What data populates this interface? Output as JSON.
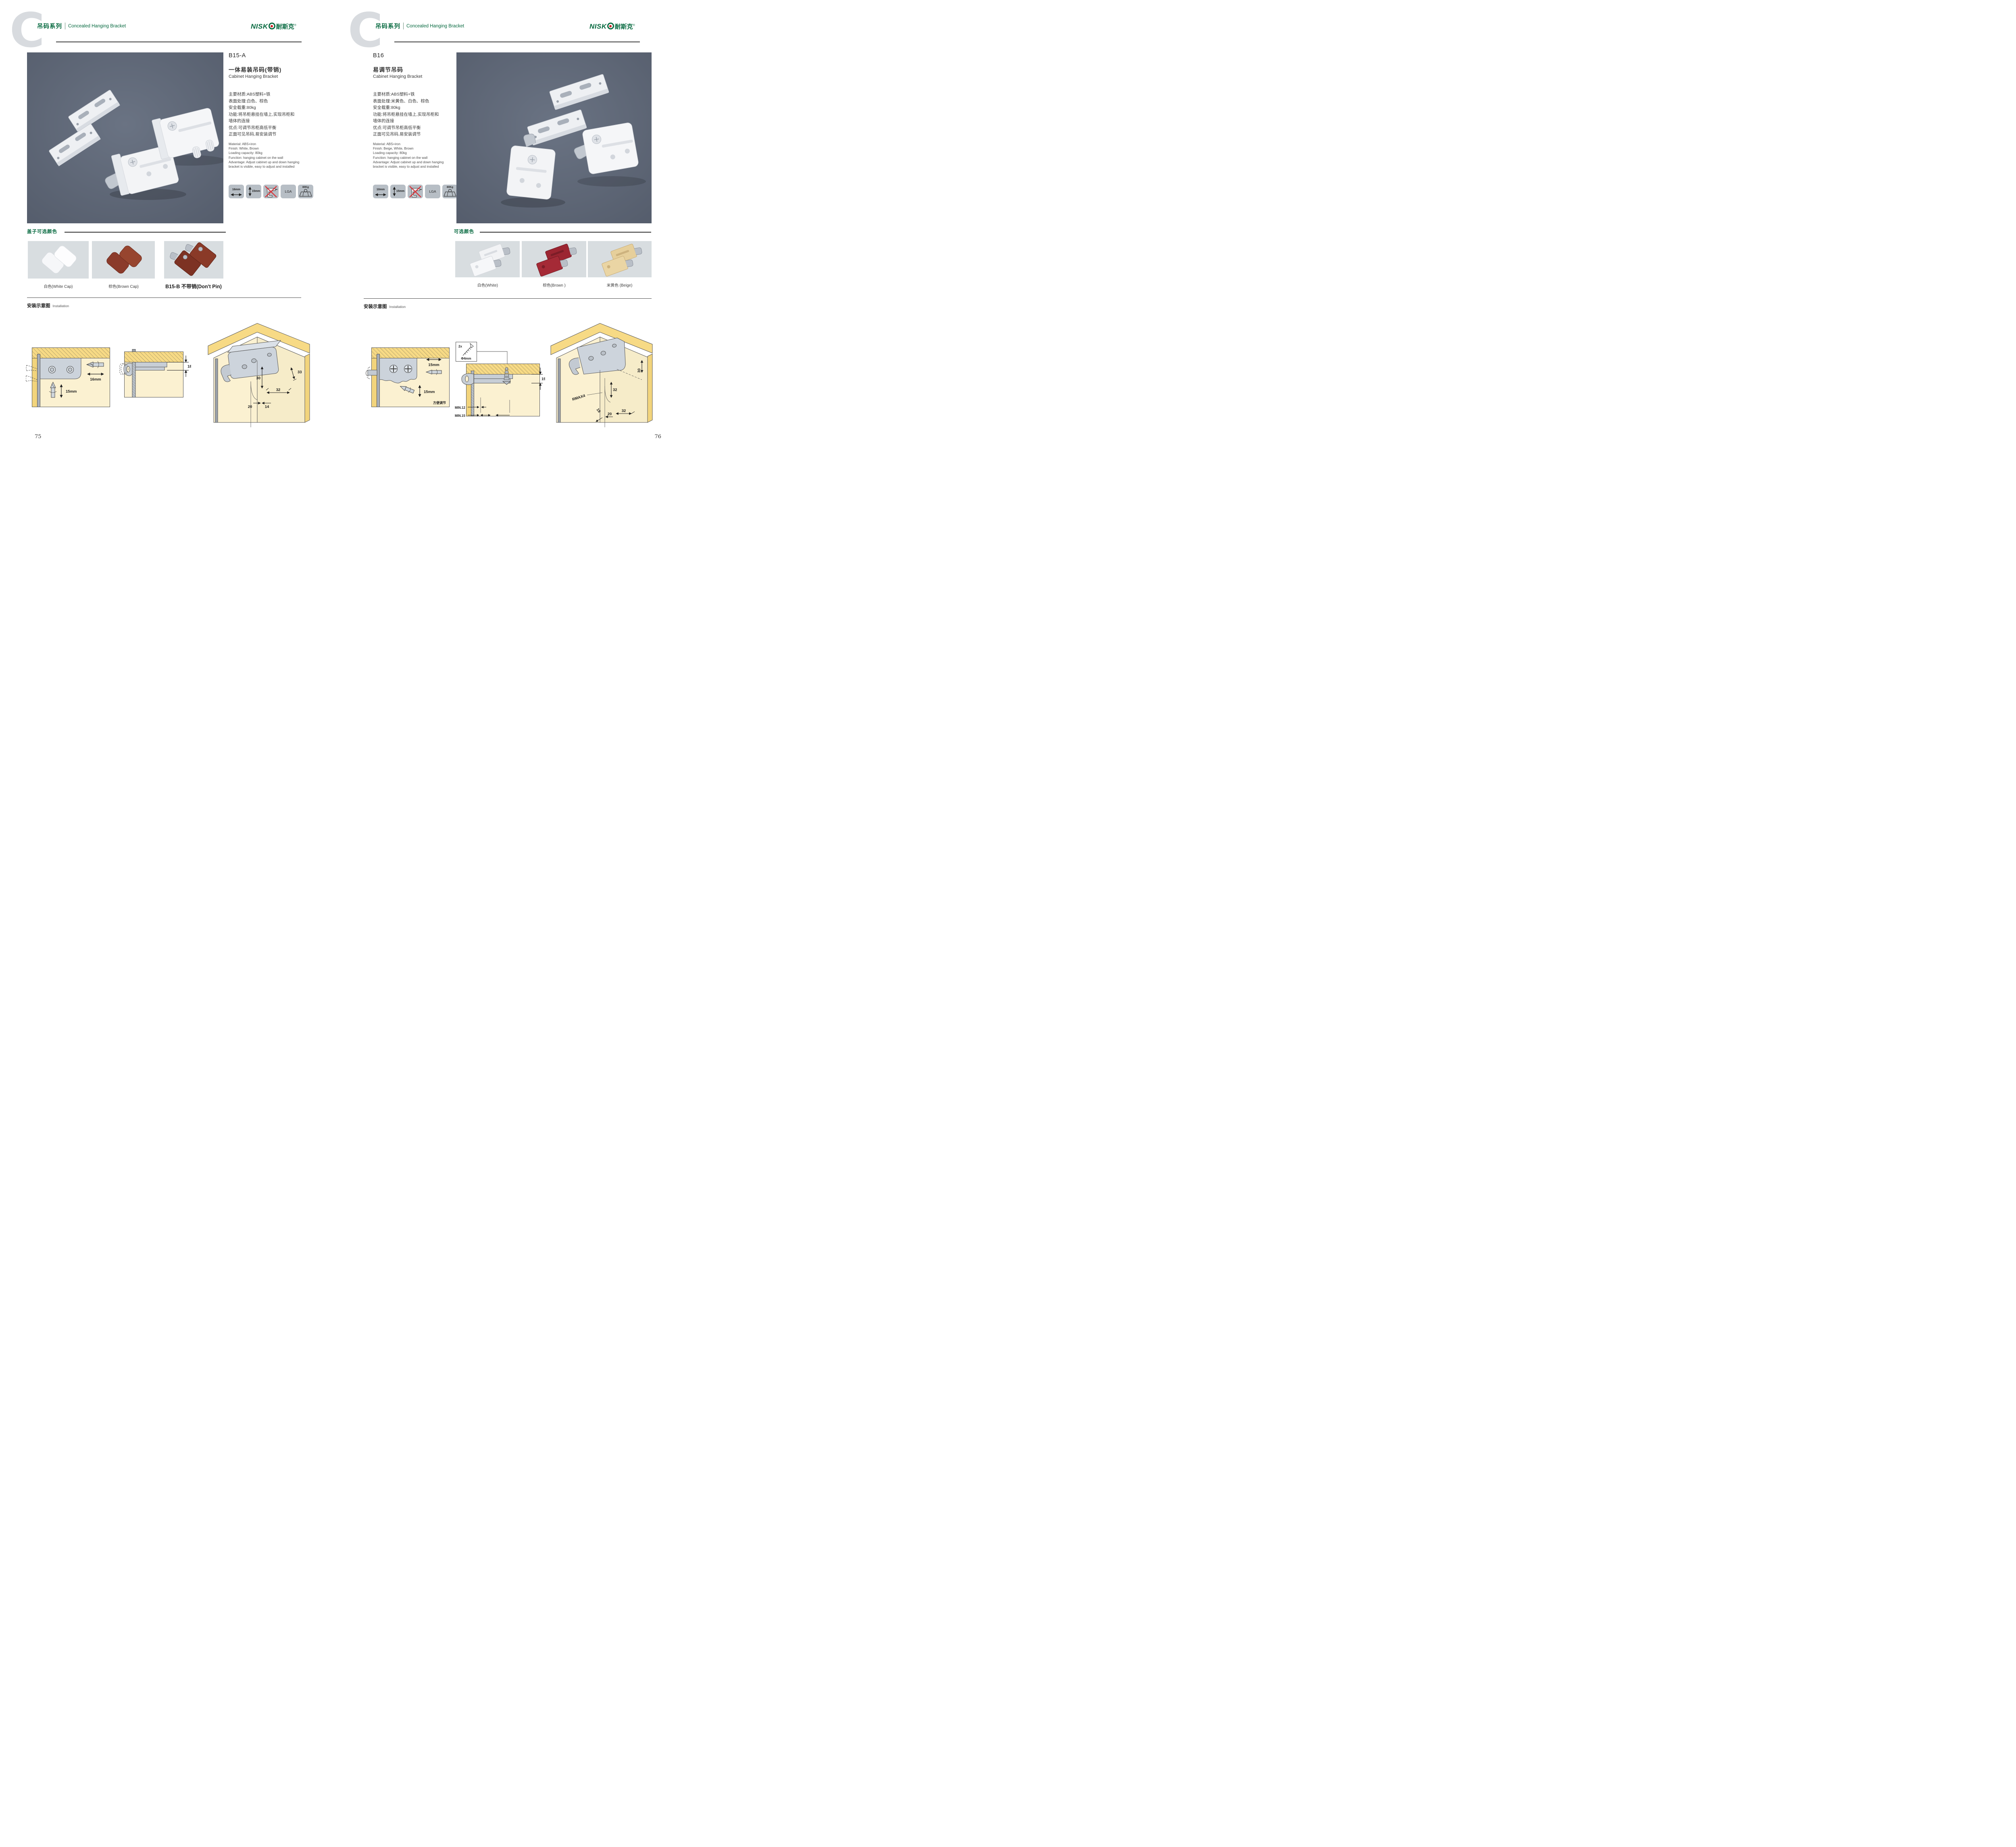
{
  "brand": {
    "latin": "NISK",
    "cn": "耐斯克",
    "reg": "®"
  },
  "colors": {
    "accent_green": "#06693f",
    "photo_bg": "#5c6473",
    "swatch_bg": "#d8dde0",
    "tile_bg": "#b7bec5",
    "wood_yellow": "#f7da85",
    "panel_cream": "#fbf1d1",
    "warn_red": "#d8363c"
  },
  "left": {
    "watermark": "C",
    "series_cn": "吊码系列",
    "series_en": "Concealed Hanging Bracket",
    "model": "B15-A",
    "name_cn": "一体易装吊码(带销)",
    "name_en": "Cabinet Hanging Bracket",
    "specs_cn": [
      "主要材质:ABS塑料+铁",
      "表面处理:白色、棕色",
      "安全载重:80kg",
      "功能:将吊柜悬挂在墙上,实现吊柜和",
      "墙体的连接",
      "优点:可调节吊柜高低平衡",
      "正面可见吊码,易安装调节"
    ],
    "specs_en": [
      "Material: ABS+iron",
      "Finish: White, Brown",
      "Loading capacity: 80kg",
      "Function: hanging cabinet on the wall",
      "Advantage: Adjust cabinet up and down hanging",
      "bracket is visible, easy to adjust and installed"
    ],
    "icons": {
      "width": "16mm",
      "height": "15mm",
      "cert": "LGA",
      "load": "80Kg"
    },
    "colors_title": "盖子可选颜色",
    "caption_white": "白色(White Cap)",
    "caption_brown": "棕色(Brown Cap)",
    "caption_b15b": "B15-B 不带销(Don't Pin)",
    "install_cn": "安装示意图",
    "install_en": "Installation",
    "d1": {
      "w": "16mm",
      "h": "15mm"
    },
    "d2": {
      "h": "18"
    },
    "d3": {
      "a": "33",
      "b": "30",
      "c": "32",
      "d": "20",
      "e": "14"
    },
    "page_no": "75"
  },
  "right": {
    "watermark": "C",
    "series_cn": "吊码系列",
    "series_en": "Concealed Hanging Bracket",
    "model": "B16",
    "name_cn": "易调节吊码",
    "name_en": "Cabinet Hanging Bracket",
    "specs_cn": [
      "主要材质:ABS塑料+铁",
      "表面处理:米黄色、白色、棕色",
      "安全载重:80kg",
      "功能:将吊柜悬挂在墙上,实现吊柜和",
      "墙体的连接",
      "优点:可调节吊柜高低平衡",
      "正面可见吊码,易安装调节"
    ],
    "specs_en": [
      "Material: ABS+iron",
      "Finish: Beige, White, Brown",
      "Loading capacity: 80kg",
      "Function: hanging cabinet on the wall",
      "Advantage: Adjust cabinet up and down hanging",
      "bracket is visible, easy to adjust and installed"
    ],
    "icons": {
      "width": "10mm",
      "height": "15mm",
      "cert": "LGA",
      "load": "80Kg"
    },
    "colors_title": "可选颜色",
    "caption_white": "白色(White)",
    "caption_brown": "棕色(Brown )",
    "caption_beige": "米黄色 (Beige)",
    "install_cn": "安装示意图",
    "install_en": "Installation",
    "d1": {
      "w": "15mm",
      "h": "15mm",
      "note": "方便调节"
    },
    "d2": {
      "qty": "2x",
      "screw": "Φ4mm",
      "h": "19",
      "min1": "MIN.12",
      "min2": "MIN.15"
    },
    "d3": {
      "a": "30",
      "b": "32",
      "c": "RMAX4",
      "d": "19",
      "e": "20",
      "f": "32"
    },
    "page_no": "76"
  }
}
